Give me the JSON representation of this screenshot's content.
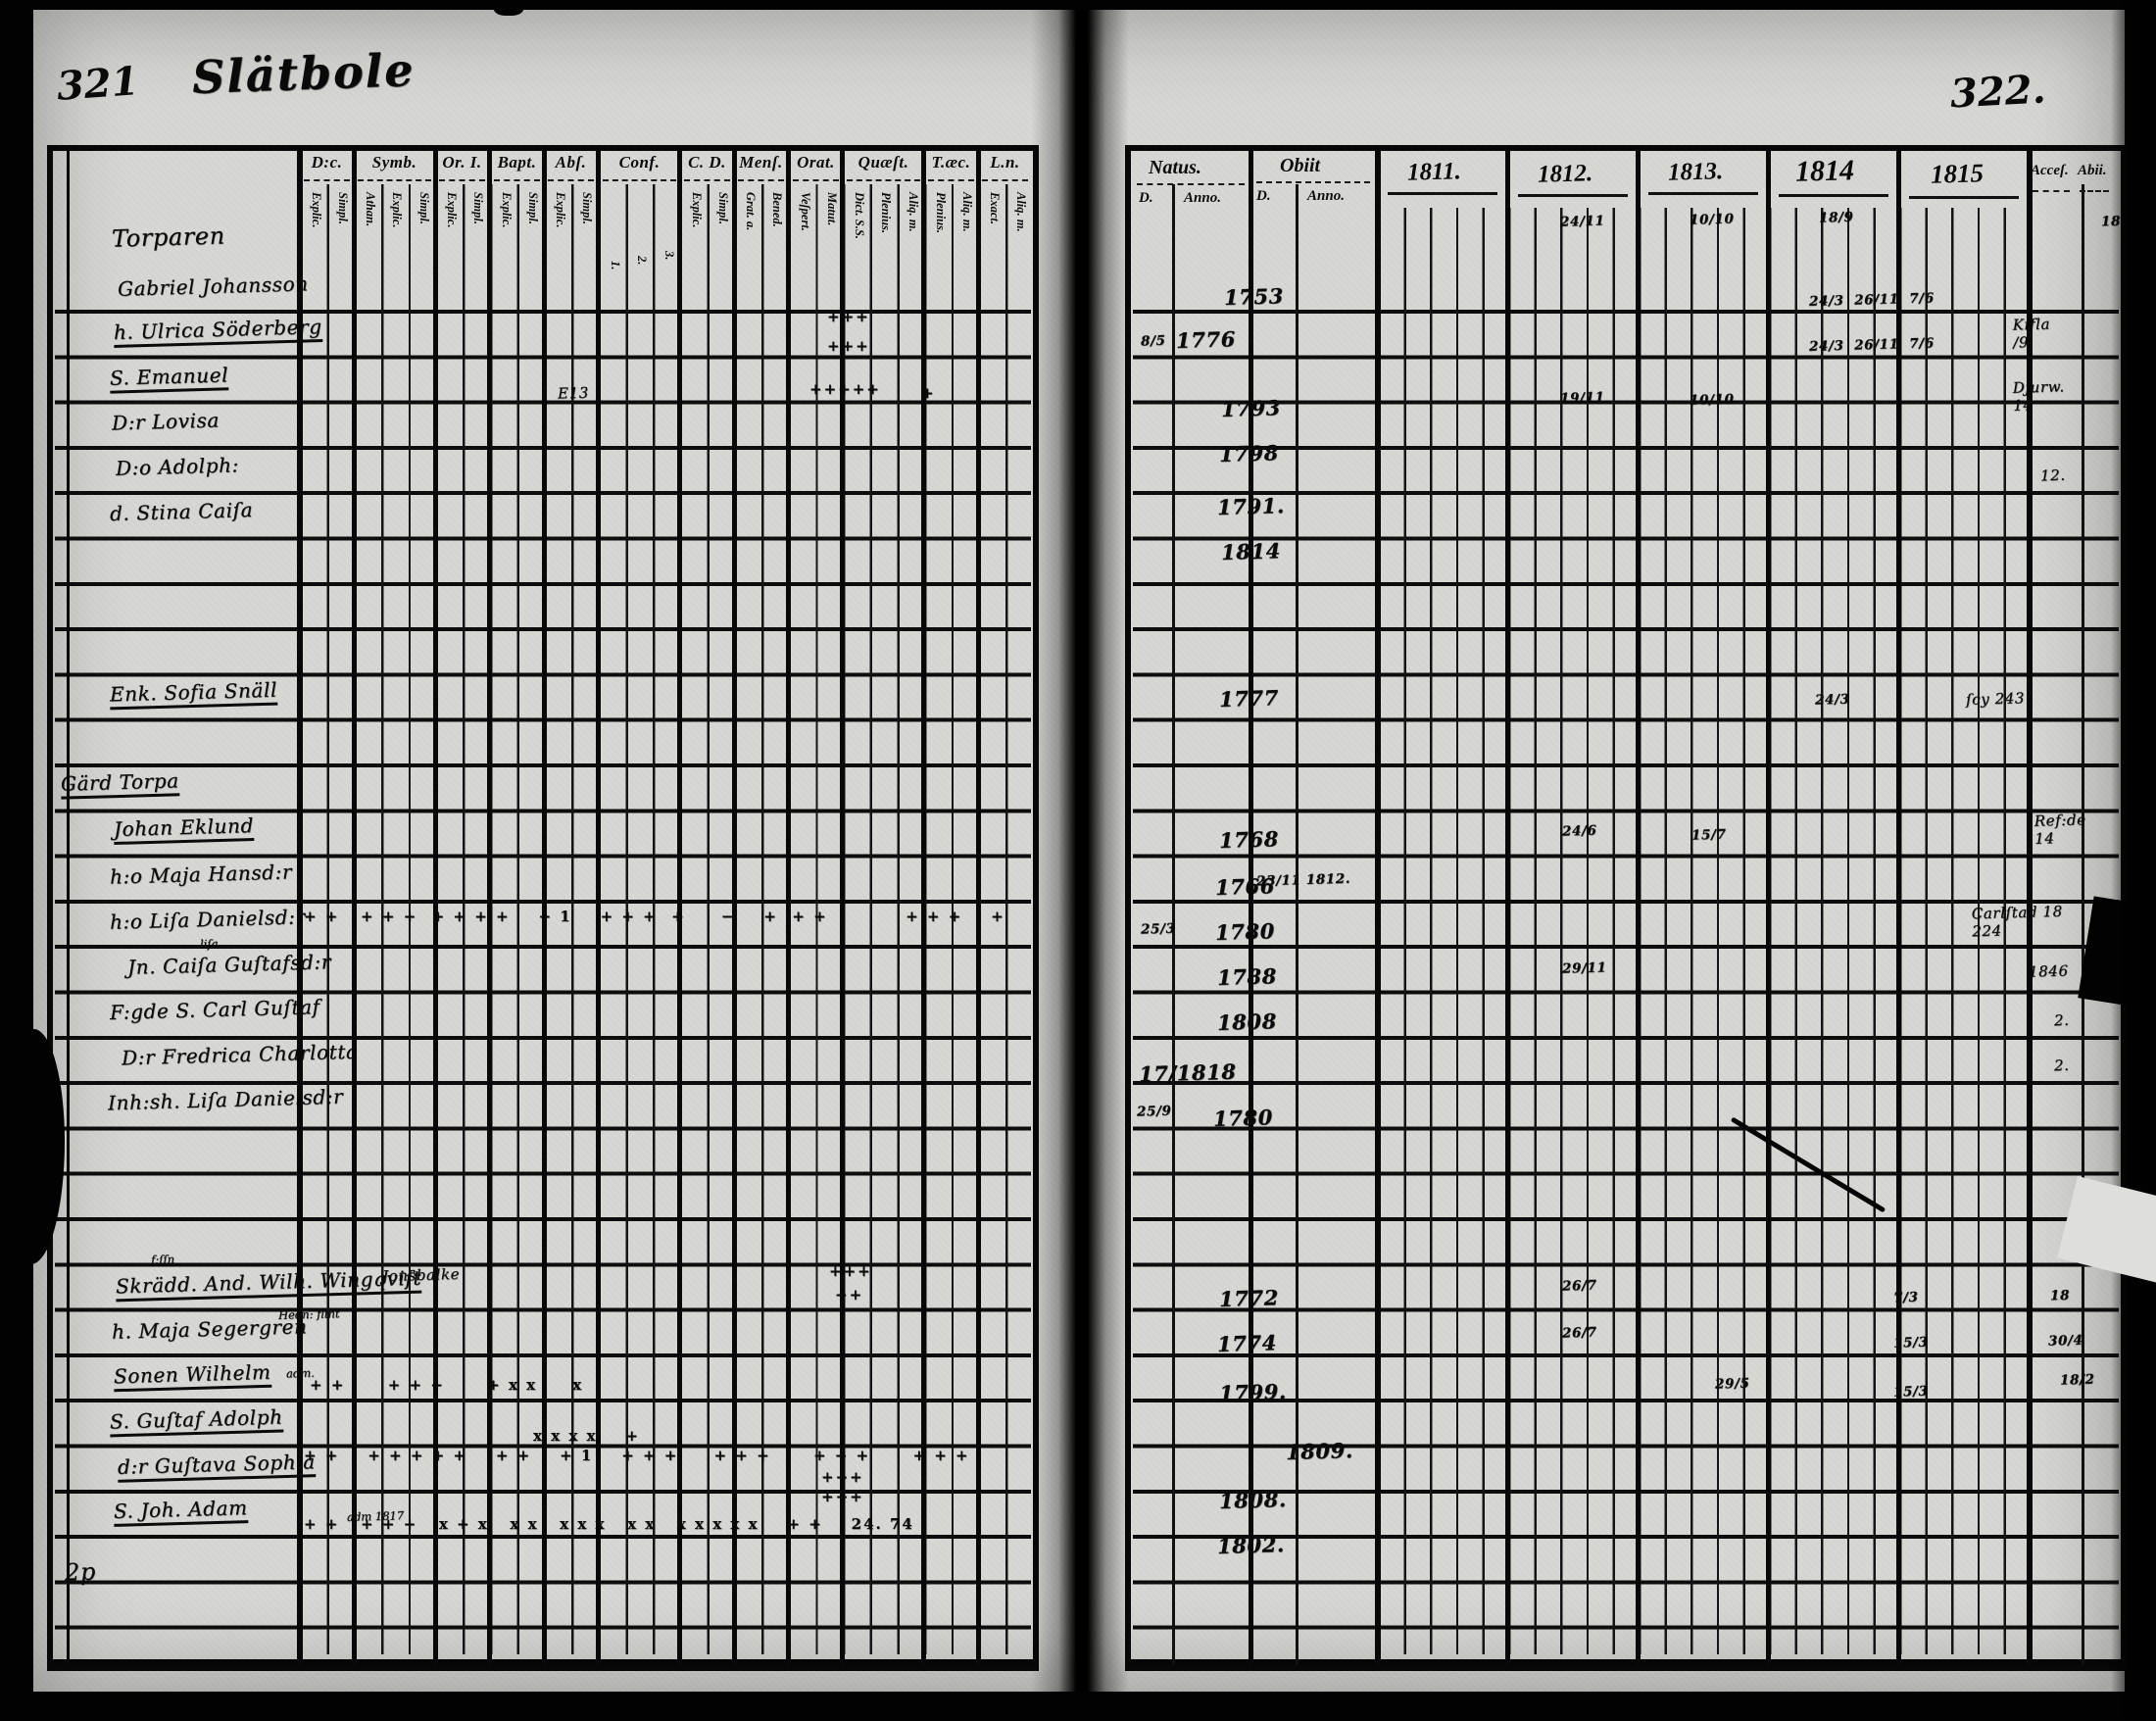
{
  "document": {
    "left_page_number": "321",
    "right_page_number": "322.",
    "title": "Slätbole",
    "bottom_left_note": "2p"
  },
  "left_table": {
    "groups": [
      {
        "label": "D:c.",
        "subs": [
          "Explic.",
          "Simpl."
        ]
      },
      {
        "label": "Symb.",
        "subs": [
          "Athan.",
          "Explic.",
          "Simpl."
        ]
      },
      {
        "label": "Or. I.",
        "subs": [
          "Explic.",
          "Simpl."
        ]
      },
      {
        "label": "Bapt.",
        "subs": [
          "Explic.",
          "Simpl."
        ]
      },
      {
        "label": "Abſ.",
        "subs": [
          "Explic.",
          "Simpl."
        ]
      },
      {
        "label": "Conf.",
        "subs": [
          "1.",
          "2.",
          "3."
        ]
      },
      {
        "label": "C. D.",
        "subs": [
          "Explic.",
          "Simpl."
        ]
      },
      {
        "label": "Menſ.",
        "subs": [
          "Grat. a.",
          "Bened."
        ]
      },
      {
        "label": "Orat.",
        "subs": [
          "Veſpert.",
          "Matut."
        ]
      },
      {
        "label": "Quæſt.",
        "subs": [
          "Dict. S.S.",
          "Plenius.",
          "Aliq. m."
        ]
      },
      {
        "label": "T.æc.",
        "subs": [
          "Plenius.",
          "Aliq. m."
        ]
      },
      {
        "label": "L.n.",
        "subs": [
          "Exact.",
          "Aliq. m."
        ]
      }
    ],
    "rows": [
      {
        "name": "Torparen"
      },
      {
        "name": "Gabriel Johansson"
      },
      {
        "name": "h. Ulrica Söderberg"
      },
      {
        "name": "S. Emanuel"
      },
      {
        "name": "D:r Lovisa"
      },
      {
        "name": "D:o Adolph:"
      },
      {
        "name": "d. Stina Caiſa"
      },
      {
        "name": ""
      },
      {
        "name": ""
      },
      {
        "name": "Enk. Sofia Snäll"
      },
      {
        "name": ""
      },
      {
        "name": "Gärd Torpa"
      },
      {
        "name": "Johan Eklund"
      },
      {
        "name": "h:o Maja Hansd:r"
      },
      {
        "name": "h:o Liſa Danielsd:r"
      },
      {
        "name": "Jn. Caiſa Guſtafsd:r"
      },
      {
        "name": "F:gde S. Carl Guſtaf"
      },
      {
        "name": "D:r Fredrica Charlotta"
      },
      {
        "name": "Inh:sh. Liſa Danielsd:r"
      },
      {
        "name": ""
      },
      {
        "name": ""
      },
      {
        "name": "Skrädd. And. Wilh. Wingqviſt"
      },
      {
        "name": "h. Maja Segergren"
      },
      {
        "name": "Sonen Wilhelm"
      },
      {
        "name": "S. Guſtaf Adolph"
      },
      {
        "name": "d:r Guſtava Sophia"
      },
      {
        "name": "S. Joh. Adam"
      },
      {
        "name": "2p"
      }
    ],
    "notes": [
      {
        "text": "liſa"
      },
      {
        "text": "f:ſſn"
      },
      {
        "text": "Hedn: flint"
      },
      {
        "text": "adm."
      },
      {
        "text": "adm 1817"
      },
      {
        "text": "Jonsbalke"
      },
      {
        "text": "E13"
      }
    ],
    "marks": [
      {
        "text": "+++"
      },
      {
        "text": "+++"
      },
      {
        "text": "+++++"
      },
      {
        "text": "+"
      },
      {
        "text": "+ +   + + +  + + + +    + 1    + + +  +     −    +  + +           + + +    +"
      },
      {
        "text": "+++"
      },
      {
        "text": "++"
      },
      {
        "text": "+ +      + + +      + x x     x"
      },
      {
        "text": "x x x x    +"
      },
      {
        "text": "+ +    + + + + +    + +    + 1    + + +     + + +      + + +      + + +"
      },
      {
        "text": "+++"
      },
      {
        "text": "+++"
      },
      {
        "text": "+ +   + + +   x + x   x x   x x x   x x   x x x x x    + +    24. 74"
      }
    ]
  },
  "right_table": {
    "headers": {
      "natus": "Natus.",
      "obiit": "Obiit",
      "d": "D.",
      "anno": "Anno.",
      "acces": "Acceſ.",
      "abiit": "Abii.",
      "years": [
        "1811.",
        "1812.",
        "1813.",
        "1814",
        "1815"
      ]
    },
    "cells": [
      {
        "text": "24/11"
      },
      {
        "text": "10/10"
      },
      {
        "text": "18/9"
      },
      {
        "text": "18"
      },
      {
        "text": "1753"
      },
      {
        "text": "24/3  26/11  7/6"
      },
      {
        "text": "8/5"
      },
      {
        "text": "1776"
      },
      {
        "text": "24/3  26/11  7/6"
      },
      {
        "text": "Kifla\n/9"
      },
      {
        "text": "1793"
      },
      {
        "text": "19/11"
      },
      {
        "text": "10/10"
      },
      {
        "text": "Djurw.\n14"
      },
      {
        "text": "1798"
      },
      {
        "text": "12."
      },
      {
        "text": "1791."
      },
      {
        "text": "1814"
      },
      {
        "text": "1777"
      },
      {
        "text": "24/3"
      },
      {
        "text": "ſcy  243"
      },
      {
        "text": "1768"
      },
      {
        "text": "24/6"
      },
      {
        "text": "15/7"
      },
      {
        "text": "Ref:de\n14"
      },
      {
        "text": "1766"
      },
      {
        "text": "23/11 1812."
      },
      {
        "text": "25/3"
      },
      {
        "text": "1780"
      },
      {
        "text": "Carlſtad 18\n224"
      },
      {
        "text": "1788"
      },
      {
        "text": "29/11"
      },
      {
        "text": "1846"
      },
      {
        "text": "1808"
      },
      {
        "text": "2."
      },
      {
        "text": "17/1818"
      },
      {
        "text": "2."
      },
      {
        "text": "25/9"
      },
      {
        "text": "1780"
      },
      {
        "text": "1772"
      },
      {
        "text": "26/7"
      },
      {
        "text": "7/3"
      },
      {
        "text": "18"
      },
      {
        "text": "1774"
      },
      {
        "text": "26/7"
      },
      {
        "text": "15/3"
      },
      {
        "text": "30/4"
      },
      {
        "text": "1799."
      },
      {
        "text": "29/5"
      },
      {
        "text": "15/3"
      },
      {
        "text": "18/2"
      },
      {
        "text": "1809."
      },
      {
        "text": "1808."
      },
      {
        "text": "1802."
      }
    ]
  }
}
